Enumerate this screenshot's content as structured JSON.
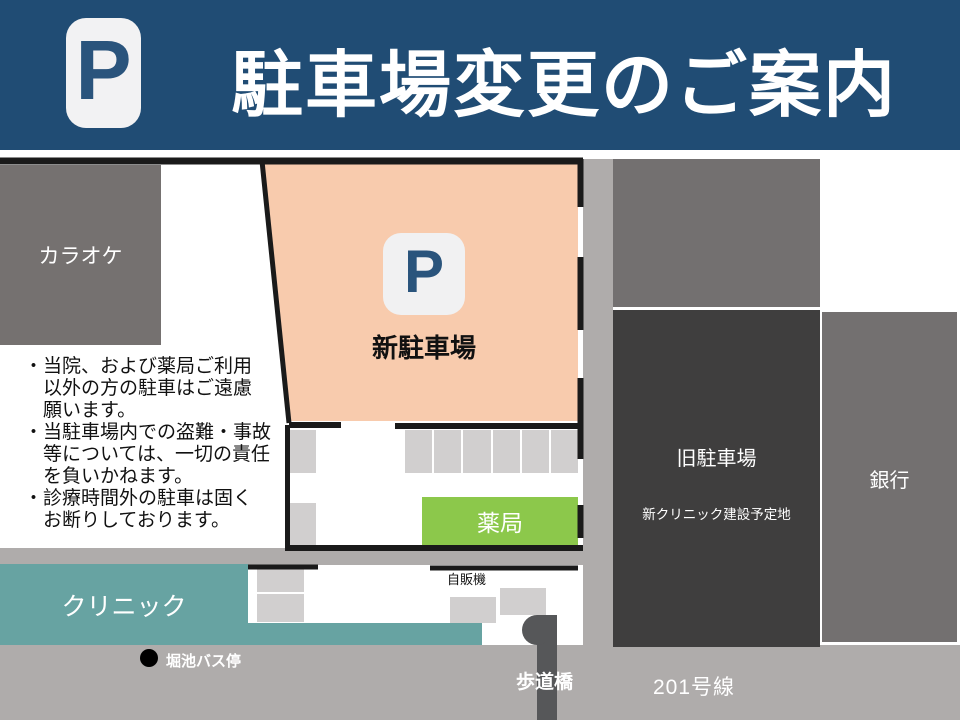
{
  "header": {
    "parking_icon": "P",
    "title": "駐車場変更のご案内"
  },
  "map": {
    "karaoke_label": "カラオケ",
    "new_parking": {
      "icon": "P",
      "label": "新駐車場"
    },
    "old_parking": {
      "label": "旧駐車場",
      "sublabel": "新クリニック建設予定地"
    },
    "bank_label": "銀行",
    "pharmacy_label": "薬局",
    "clinic_label": "クリニック",
    "vending_label": "自販機",
    "bus_stop_label": "堀池バス停",
    "footbridge_label": "歩道橋",
    "route_label": "201号線",
    "notes": [
      "・当院、および薬局ご利用",
      "　以外の方の駐車はご遠慮",
      "　願います。",
      "・当駐車場内での盗難・事故",
      "　等については、一切の責任",
      "　を負いかねます。",
      "・診療時間外の駐車は固く",
      "　お断りしております。"
    ]
  },
  "colors": {
    "header_blue": "#204C74",
    "parking_fill": "#F8CBAD",
    "building_gray": "#757170",
    "old_parking_dark": "#3F3E3E",
    "stall_gray": "#D1CFCF",
    "pharmacy_green": "#8CC84B",
    "clinic_teal": "#67A3A2",
    "road_gray": "#AFACAB",
    "p_icon_blue": "#2A547C",
    "p_icon_bg": "#F2F2F3",
    "line_black": "#1A1A1A"
  }
}
